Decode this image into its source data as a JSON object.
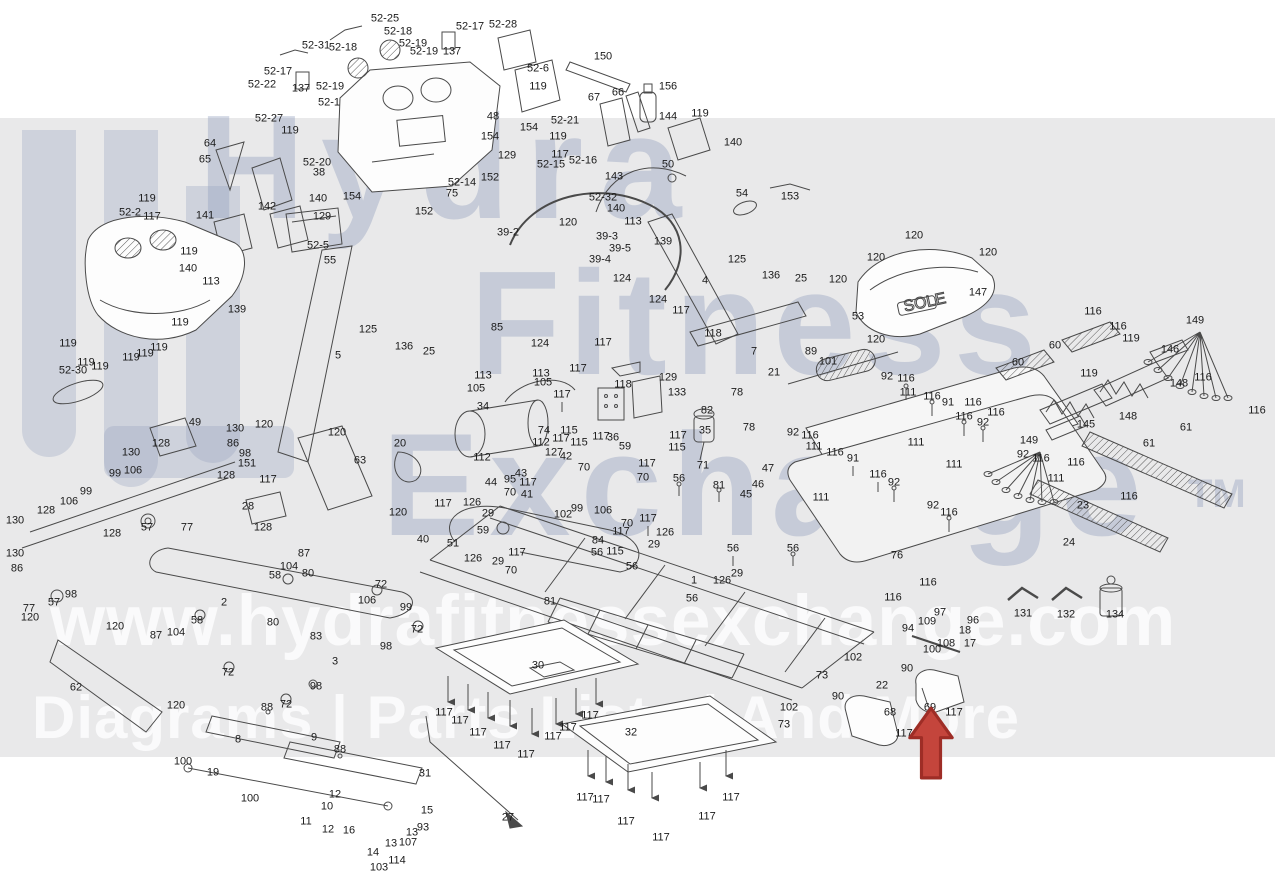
{
  "watermark": {
    "brand_line1": "Hydra",
    "brand_line2": "Fitness",
    "brand_line3": "Exchange",
    "trademark": "TM",
    "url": "www.hydrafitnessexchange.com",
    "tagline": "Diagrams | Parts Lists | And More",
    "band_color": "#e9e9ea",
    "brand_text_color": "#96a1be",
    "light_text_color": "#ffffff"
  },
  "hood_badge": "SOLE",
  "highlight": {
    "points_to_part": "69",
    "arrow_color": "#c4453c"
  },
  "labels": [
    [
      "52-25",
      385,
      19
    ],
    [
      "52-18",
      398,
      32
    ],
    [
      "52-17",
      470,
      27
    ],
    [
      "52-28",
      503,
      25
    ],
    [
      "52-31",
      316,
      46
    ],
    [
      "52-18",
      343,
      48
    ],
    [
      "52-19",
      413,
      44
    ],
    [
      "52-19",
      424,
      52
    ],
    [
      "137",
      452,
      52
    ],
    [
      "52-17",
      278,
      72
    ],
    [
      "137",
      301,
      89
    ],
    [
      "52-22",
      262,
      85
    ],
    [
      "52-19",
      330,
      87
    ],
    [
      "52-27",
      269,
      119
    ],
    [
      "52-1",
      329,
      103
    ],
    [
      "52-6",
      538,
      69
    ],
    [
      "150",
      603,
      57
    ],
    [
      "119",
      538,
      87
    ],
    [
      "67",
      594,
      98
    ],
    [
      "66",
      618,
      93
    ],
    [
      "156",
      668,
      87
    ],
    [
      "64",
      210,
      144
    ],
    [
      "65",
      205,
      160
    ],
    [
      "119",
      290,
      131
    ],
    [
      "52-20",
      317,
      163
    ],
    [
      "38",
      319,
      173
    ],
    [
      "48",
      493,
      117
    ],
    [
      "154",
      490,
      137
    ],
    [
      "154",
      529,
      128
    ],
    [
      "129",
      507,
      156
    ],
    [
      "52-21",
      565,
      121
    ],
    [
      "119",
      558,
      137
    ],
    [
      "117",
      560,
      155
    ],
    [
      "52-15",
      551,
      165
    ],
    [
      "52-16",
      583,
      161
    ],
    [
      "143",
      614,
      177
    ],
    [
      "152",
      490,
      178
    ],
    [
      "52-14",
      462,
      183
    ],
    [
      "75",
      452,
      194
    ],
    [
      "152",
      424,
      212
    ],
    [
      "52-32",
      603,
      198
    ],
    [
      "154",
      352,
      197
    ],
    [
      "140",
      318,
      199
    ],
    [
      "142",
      267,
      207
    ],
    [
      "141",
      205,
      216
    ],
    [
      "129",
      322,
      217
    ],
    [
      "52-5",
      318,
      246
    ],
    [
      "55",
      330,
      261
    ],
    [
      "52-2",
      130,
      213
    ],
    [
      "52-30",
      73,
      371
    ],
    [
      "119",
      147,
      199
    ],
    [
      "117",
      152,
      217
    ],
    [
      "140",
      188,
      269
    ],
    [
      "119",
      189,
      252
    ],
    [
      "113",
      211,
      282
    ],
    [
      "139",
      237,
      310
    ],
    [
      "119",
      68,
      344
    ],
    [
      "119",
      86,
      363
    ],
    [
      "119",
      100,
      367
    ],
    [
      "119",
      131,
      358
    ],
    [
      "119",
      145,
      354
    ],
    [
      "119",
      159,
      348
    ],
    [
      "119",
      180,
      323
    ],
    [
      "5",
      338,
      356
    ],
    [
      "125",
      368,
      330
    ],
    [
      "136",
      404,
      347
    ],
    [
      "25",
      429,
      352
    ],
    [
      "85",
      497,
      328
    ],
    [
      "124",
      540,
      344
    ],
    [
      "117",
      603,
      343
    ],
    [
      "118",
      713,
      334
    ],
    [
      "124",
      622,
      279
    ],
    [
      "124",
      658,
      300
    ],
    [
      "117",
      681,
      311
    ],
    [
      "144",
      668,
      117
    ],
    [
      "119",
      700,
      114
    ],
    [
      "140",
      733,
      143
    ],
    [
      "50",
      668,
      165
    ],
    [
      "54",
      742,
      194
    ],
    [
      "153",
      790,
      197
    ],
    [
      "140",
      616,
      209
    ],
    [
      "113",
      633,
      222
    ],
    [
      "139",
      663,
      242
    ],
    [
      "120",
      568,
      223
    ],
    [
      "39-2",
      508,
      233
    ],
    [
      "39-3",
      607,
      237
    ],
    [
      "39-5",
      620,
      249
    ],
    [
      "39-4",
      600,
      260
    ],
    [
      "4",
      705,
      281
    ],
    [
      "125",
      737,
      260
    ],
    [
      "136",
      771,
      276
    ],
    [
      "25",
      801,
      279
    ],
    [
      "120",
      914,
      236
    ],
    [
      "120",
      876,
      258
    ],
    [
      "120",
      988,
      253
    ],
    [
      "120",
      876,
      340
    ],
    [
      "120",
      838,
      280
    ],
    [
      "147",
      978,
      293
    ],
    [
      "53",
      858,
      317
    ],
    [
      "116",
      1093,
      312
    ],
    [
      "60",
      1055,
      346
    ],
    [
      "116",
      1118,
      327
    ],
    [
      "119",
      1131,
      339
    ],
    [
      "149",
      1195,
      321
    ],
    [
      "146",
      1170,
      350
    ],
    [
      "119",
      1089,
      374
    ],
    [
      "148",
      1179,
      384
    ],
    [
      "116",
      1203,
      378
    ],
    [
      "148",
      1128,
      417
    ],
    [
      "145",
      1086,
      425
    ],
    [
      "116",
      1257,
      411
    ],
    [
      "61",
      1186,
      428
    ],
    [
      "61",
      1149,
      444
    ],
    [
      "116",
      1076,
      463
    ],
    [
      "111",
      1056,
      479
    ],
    [
      "149",
      1029,
      441
    ],
    [
      "116",
      973,
      403
    ],
    [
      "116",
      996,
      413
    ],
    [
      "60",
      1018,
      363
    ],
    [
      "116",
      1041,
      459
    ],
    [
      "92",
      1023,
      455
    ],
    [
      "23",
      1083,
      506
    ],
    [
      "116",
      1129,
      497
    ],
    [
      "24",
      1069,
      543
    ],
    [
      "92",
      887,
      377
    ],
    [
      "116",
      906,
      379
    ],
    [
      "111",
      908,
      393
    ],
    [
      "116",
      932,
      397
    ],
    [
      "91",
      948,
      403
    ],
    [
      "116",
      964,
      417
    ],
    [
      "92",
      983,
      423
    ],
    [
      "111",
      916,
      443
    ],
    [
      "111",
      954,
      465
    ],
    [
      "91",
      853,
      459
    ],
    [
      "116",
      878,
      475
    ],
    [
      "92",
      894,
      483
    ],
    [
      "92",
      933,
      506
    ],
    [
      "116",
      949,
      513
    ],
    [
      "111",
      821,
      498
    ],
    [
      "92",
      793,
      433
    ],
    [
      "116",
      810,
      436
    ],
    [
      "111",
      814,
      447
    ],
    [
      "116",
      835,
      453
    ],
    [
      "47",
      768,
      469
    ],
    [
      "46",
      758,
      485
    ],
    [
      "45",
      746,
      495
    ],
    [
      "7",
      754,
      352
    ],
    [
      "89",
      811,
      352
    ],
    [
      "101",
      828,
      362
    ],
    [
      "21",
      774,
      373
    ],
    [
      "78",
      737,
      393
    ],
    [
      "78",
      749,
      428
    ],
    [
      "82",
      707,
      411
    ],
    [
      "35",
      705,
      431
    ],
    [
      "117",
      678,
      436
    ],
    [
      "115",
      677,
      448
    ],
    [
      "71",
      703,
      466
    ],
    [
      "34",
      483,
      407
    ],
    [
      "74",
      544,
      431
    ],
    [
      "112",
      541,
      443
    ],
    [
      "112",
      482,
      458
    ],
    [
      "113",
      483,
      376
    ],
    [
      "113",
      541,
      374
    ],
    [
      "105",
      543,
      383
    ],
    [
      "105",
      476,
      389
    ],
    [
      "117",
      562,
      395
    ],
    [
      "115",
      569,
      431
    ],
    [
      "117",
      561,
      439
    ],
    [
      "115",
      579,
      443
    ],
    [
      "117",
      578,
      369
    ],
    [
      "118",
      623,
      385
    ],
    [
      "129",
      668,
      378
    ],
    [
      "133",
      677,
      393
    ],
    [
      "117",
      601,
      437
    ],
    [
      "36",
      613,
      438
    ],
    [
      "59",
      625,
      447
    ],
    [
      "127",
      554,
      453
    ],
    [
      "42",
      566,
      457
    ],
    [
      "70",
      584,
      468
    ],
    [
      "44",
      491,
      483
    ],
    [
      "95",
      510,
      480
    ],
    [
      "43",
      521,
      474
    ],
    [
      "117",
      528,
      483
    ],
    [
      "70",
      510,
      493
    ],
    [
      "41",
      527,
      495
    ],
    [
      "117",
      647,
      464
    ],
    [
      "70",
      643,
      478
    ],
    [
      "56",
      679,
      479
    ],
    [
      "81",
      719,
      486
    ],
    [
      "117",
      648,
      519
    ],
    [
      "70",
      627,
      524
    ],
    [
      "117",
      621,
      532
    ],
    [
      "126",
      665,
      533
    ],
    [
      "29",
      654,
      545
    ],
    [
      "84",
      598,
      541
    ],
    [
      "56",
      597,
      553
    ],
    [
      "115",
      615,
      552
    ],
    [
      "102",
      563,
      515
    ],
    [
      "99",
      577,
      509
    ],
    [
      "106",
      603,
      511
    ],
    [
      "59",
      483,
      531
    ],
    [
      "51",
      453,
      544
    ],
    [
      "117",
      443,
      504
    ],
    [
      "126",
      472,
      503
    ],
    [
      "29",
      488,
      514
    ],
    [
      "126",
      473,
      559
    ],
    [
      "29",
      498,
      562
    ],
    [
      "117",
      517,
      553
    ],
    [
      "70",
      511,
      571
    ],
    [
      "81",
      550,
      602
    ],
    [
      "56",
      632,
      567
    ],
    [
      "1",
      694,
      581
    ],
    [
      "56",
      692,
      599
    ],
    [
      "126",
      722,
      581
    ],
    [
      "29",
      737,
      574
    ],
    [
      "56",
      733,
      549
    ],
    [
      "56",
      793,
      549
    ],
    [
      "49",
      195,
      423
    ],
    [
      "130",
      235,
      429
    ],
    [
      "120",
      264,
      425
    ],
    [
      "120",
      337,
      433
    ],
    [
      "63",
      360,
      461
    ],
    [
      "20",
      400,
      444
    ],
    [
      "128",
      161,
      444
    ],
    [
      "86",
      233,
      444
    ],
    [
      "98",
      245,
      454
    ],
    [
      "151",
      247,
      464
    ],
    [
      "117",
      268,
      480
    ],
    [
      "128",
      226,
      476
    ],
    [
      "130",
      131,
      453
    ],
    [
      "99",
      115,
      474
    ],
    [
      "106",
      133,
      471
    ],
    [
      "99",
      86,
      492
    ],
    [
      "106",
      69,
      502
    ],
    [
      "128",
      46,
      511
    ],
    [
      "130",
      15,
      521
    ],
    [
      "130",
      15,
      554
    ],
    [
      "86",
      17,
      569
    ],
    [
      "128",
      112,
      534
    ],
    [
      "28",
      248,
      507
    ],
    [
      "57",
      147,
      528
    ],
    [
      "77",
      187,
      528
    ],
    [
      "128",
      263,
      528
    ],
    [
      "120",
      398,
      513
    ],
    [
      "40",
      423,
      540
    ],
    [
      "87",
      304,
      554
    ],
    [
      "104",
      289,
      567
    ],
    [
      "58",
      275,
      576
    ],
    [
      "80",
      308,
      574
    ],
    [
      "72",
      381,
      585
    ],
    [
      "106",
      367,
      601
    ],
    [
      "99",
      406,
      608
    ],
    [
      "72",
      417,
      630
    ],
    [
      "98",
      386,
      647
    ],
    [
      "57",
      54,
      603
    ],
    [
      "98",
      71,
      595
    ],
    [
      "77",
      29,
      609
    ],
    [
      "120",
      30,
      618
    ],
    [
      "2",
      224,
      603
    ],
    [
      "58",
      197,
      621
    ],
    [
      "104",
      176,
      633
    ],
    [
      "87",
      156,
      636
    ],
    [
      "80",
      273,
      623
    ],
    [
      "83",
      316,
      637
    ],
    [
      "3",
      335,
      662
    ],
    [
      "62",
      76,
      688
    ],
    [
      "120",
      115,
      627
    ],
    [
      "120",
      176,
      706
    ],
    [
      "88",
      267,
      708
    ],
    [
      "72",
      286,
      705
    ],
    [
      "98",
      316,
      687
    ],
    [
      "72",
      228,
      673
    ],
    [
      "8",
      238,
      740
    ],
    [
      "9",
      314,
      738
    ],
    [
      "88",
      340,
      750
    ],
    [
      "100",
      183,
      762
    ],
    [
      "19",
      213,
      773
    ],
    [
      "100",
      250,
      799
    ],
    [
      "12",
      335,
      795
    ],
    [
      "10",
      327,
      807
    ],
    [
      "11",
      306,
      822
    ],
    [
      "12",
      328,
      830
    ],
    [
      "16",
      349,
      831
    ],
    [
      "15",
      427,
      811
    ],
    [
      "93",
      423,
      828
    ],
    [
      "13",
      412,
      833
    ],
    [
      "13",
      391,
      844
    ],
    [
      "107",
      408,
      843
    ],
    [
      "14",
      373,
      853
    ],
    [
      "114",
      397,
      861
    ],
    [
      "103",
      379,
      868
    ],
    [
      "31",
      425,
      774
    ],
    [
      "27",
      508,
      818
    ],
    [
      "30",
      538,
      666
    ],
    [
      "32",
      631,
      733
    ],
    [
      "117",
      444,
      713
    ],
    [
      "117",
      460,
      721
    ],
    [
      "117",
      478,
      733
    ],
    [
      "117",
      502,
      746
    ],
    [
      "117",
      526,
      755
    ],
    [
      "117",
      553,
      737
    ],
    [
      "117",
      568,
      728
    ],
    [
      "117",
      590,
      716
    ],
    [
      "117",
      585,
      798
    ],
    [
      "117",
      601,
      800
    ],
    [
      "117",
      626,
      822
    ],
    [
      "117",
      661,
      838
    ],
    [
      "117",
      707,
      817
    ],
    [
      "117",
      731,
      798
    ],
    [
      "73",
      784,
      725
    ],
    [
      "102",
      789,
      708
    ],
    [
      "73",
      822,
      676
    ],
    [
      "102",
      853,
      658
    ],
    [
      "90",
      838,
      697
    ],
    [
      "90",
      907,
      669
    ],
    [
      "22",
      882,
      686
    ],
    [
      "68",
      890,
      713
    ],
    [
      "69",
      930,
      708
    ],
    [
      "117",
      954,
      713
    ],
    [
      "117",
      904,
      734
    ],
    [
      "131",
      1023,
      614
    ],
    [
      "132",
      1066,
      615
    ],
    [
      "134",
      1115,
      615
    ],
    [
      "76",
      897,
      556
    ],
    [
      "116",
      928,
      583
    ],
    [
      "116",
      893,
      598
    ],
    [
      "97",
      940,
      613
    ],
    [
      "96",
      973,
      621
    ],
    [
      "109",
      927,
      622
    ],
    [
      "94",
      908,
      629
    ],
    [
      "18",
      965,
      631
    ],
    [
      "108",
      946,
      644
    ],
    [
      "17",
      970,
      644
    ],
    [
      "100",
      932,
      650
    ]
  ]
}
